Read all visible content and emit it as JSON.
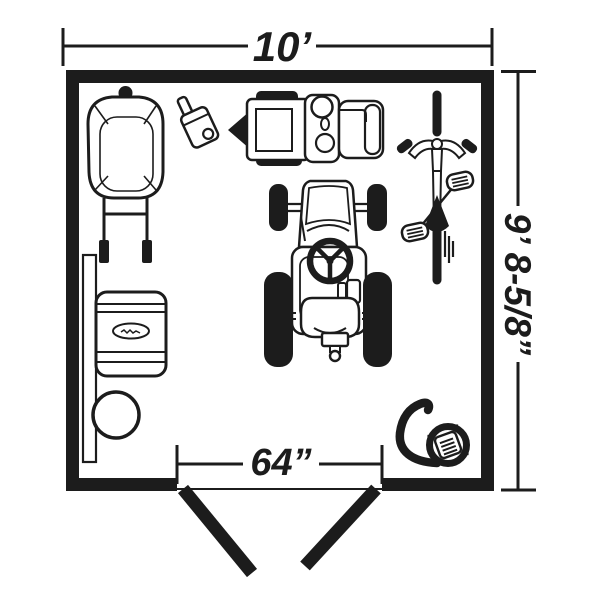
{
  "colors": {
    "ink": "#1c1c1c",
    "background": "#ffffff"
  },
  "dims": {
    "width": "10’",
    "height": "9’ 8-5/8”",
    "door": "64”"
  },
  "objects": [
    "bbq-grill",
    "gas-can",
    "snow-blower",
    "bicycle",
    "riding-mower",
    "wall-board",
    "storage-bin",
    "bucket",
    "hose-reel",
    "double-door"
  ]
}
